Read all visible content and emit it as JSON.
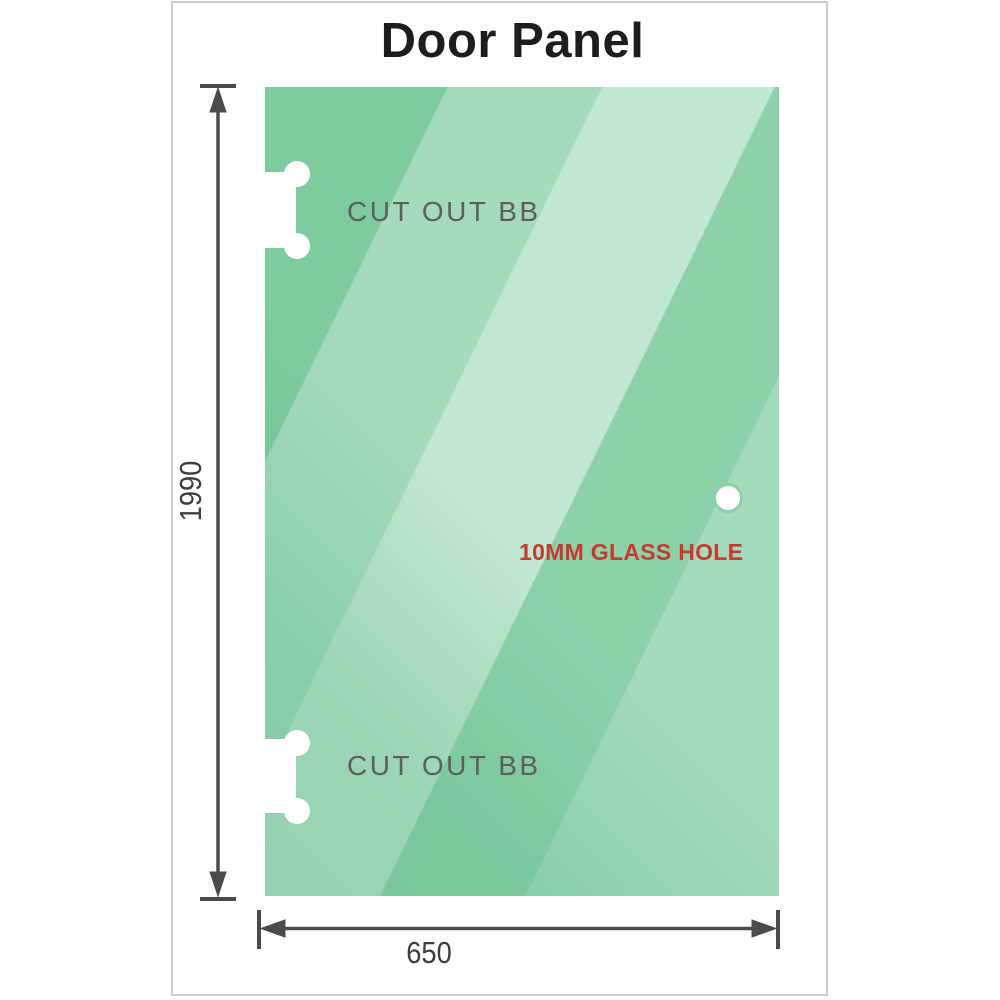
{
  "title": "Door Panel",
  "panel": {
    "cutouts": [
      {
        "label": "CUT OUT BB"
      },
      {
        "label": "CUT OUT BB"
      }
    ],
    "hole": {
      "label": "10MM GLASS HOLE"
    }
  },
  "dimensions": {
    "height": "1990",
    "width": "650"
  },
  "colors": {
    "glass_base": "#7dcb9f",
    "glass_highlight": "#cdebd8",
    "hole_ring": "#8bd2ac",
    "title_text": "#1d1d1d",
    "dimension_line": "#4b4b4b",
    "dimension_text": "#3d3d3d",
    "cutout_label_text": "#5c605d",
    "hole_label_text": "#c53b30",
    "card_border": "#cbcdcc"
  }
}
